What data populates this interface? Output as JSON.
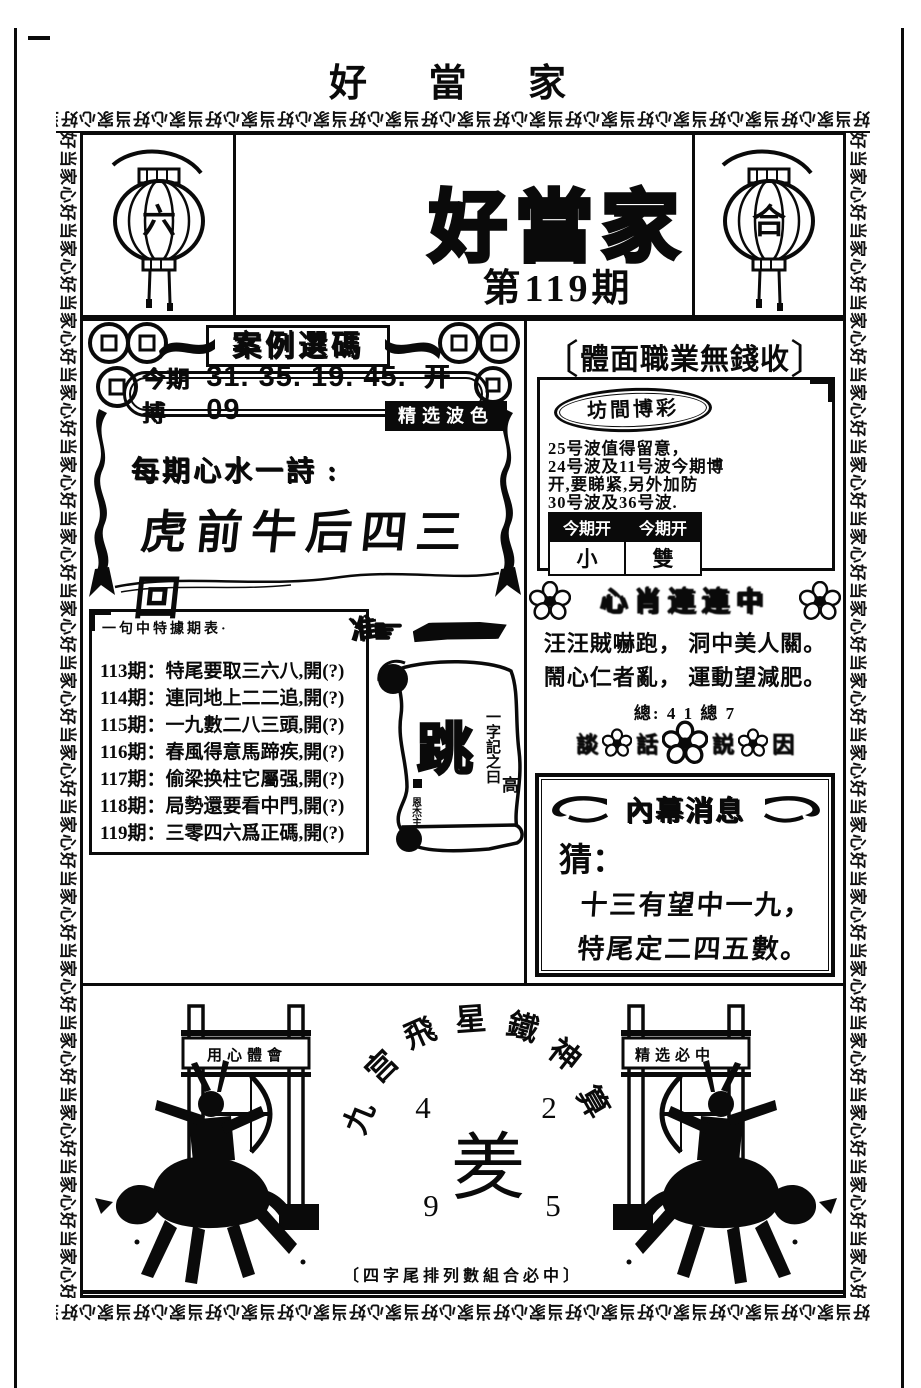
{
  "page": {
    "top_title": "好 當 家",
    "border_unit": "好当家心",
    "colors": {
      "ink": "#0a0a0a",
      "paper": "#ffffff"
    }
  },
  "masthead": {
    "title": "好當家",
    "issue": "第119期",
    "left_lantern_char": "六",
    "right_lantern_char": "合"
  },
  "left_panel": {
    "section_title": "案例選碼",
    "pill": {
      "label": "今期搏",
      "numbers": "31. 35. 19. 45. 09",
      "suffix": "开旺"
    },
    "badge": "精选波色",
    "poem_label": "每期心水一詩 :",
    "poem": "虎前牛后四三回",
    "history": {
      "header": "一句中特據期表·",
      "rows": [
        "113期：特尾要取三六八,開(?)",
        "114期：連同地上二二追,開(?)",
        "115期：一九數二八三頭,開(?)",
        "116期：春風得意馬蹄疾,開(?)",
        "117期：偷梁换柱它屬强,開(?)",
        "118期：局勢還要看中門,開(?)",
        "119期：三零四六爲正碼,開(?)"
      ]
    },
    "mark_char": "准",
    "hand_glyph": "☛",
    "scroll": {
      "vertical_label": "一字記之曰",
      "big_char": "跳",
      "small_char": "高",
      "seal": "恩杰主"
    }
  },
  "right_panel": {
    "bracket_left": "〔",
    "header": "體面職業無錢收",
    "bracket_right": "〕",
    "tips": {
      "oval_title": "坊間博彩",
      "lines": [
        "25号波值得留意，",
        "24号波及11号波今期博",
        "开,要睇紧,另外加防",
        "30号波及36号波."
      ],
      "table": {
        "headers": [
          "今期开",
          "今期开"
        ],
        "values": [
          "小",
          "雙"
        ]
      }
    },
    "smudge_banner": "心肖連連中",
    "poem_lines": [
      "汪汪賊嚇跑， 洞中美人關。",
      "鬧心仁者亂， 運動望減肥。"
    ],
    "total_line": "總: 4 1 總 7",
    "flower_row_chars": [
      "談",
      "話",
      "説",
      "因"
    ],
    "insider": {
      "title": "內幕消息",
      "guess_label": "猜：",
      "lines": [
        "十三有望中一九，",
        "特尾定二四五數。"
      ]
    }
  },
  "bottom": {
    "arc_chars": [
      "九",
      "宫",
      "飛",
      "星",
      "鐵",
      "神",
      "算"
    ],
    "numbers": {
      "top_left": "4",
      "top_right": "2",
      "bottom_left": "9",
      "bottom_right": "5"
    },
    "center_char": "羑",
    "caption": "〔四字尾排列數組合必中〕",
    "left_gate_banner": "用心體會",
    "right_gate_banner": "精选必中"
  }
}
